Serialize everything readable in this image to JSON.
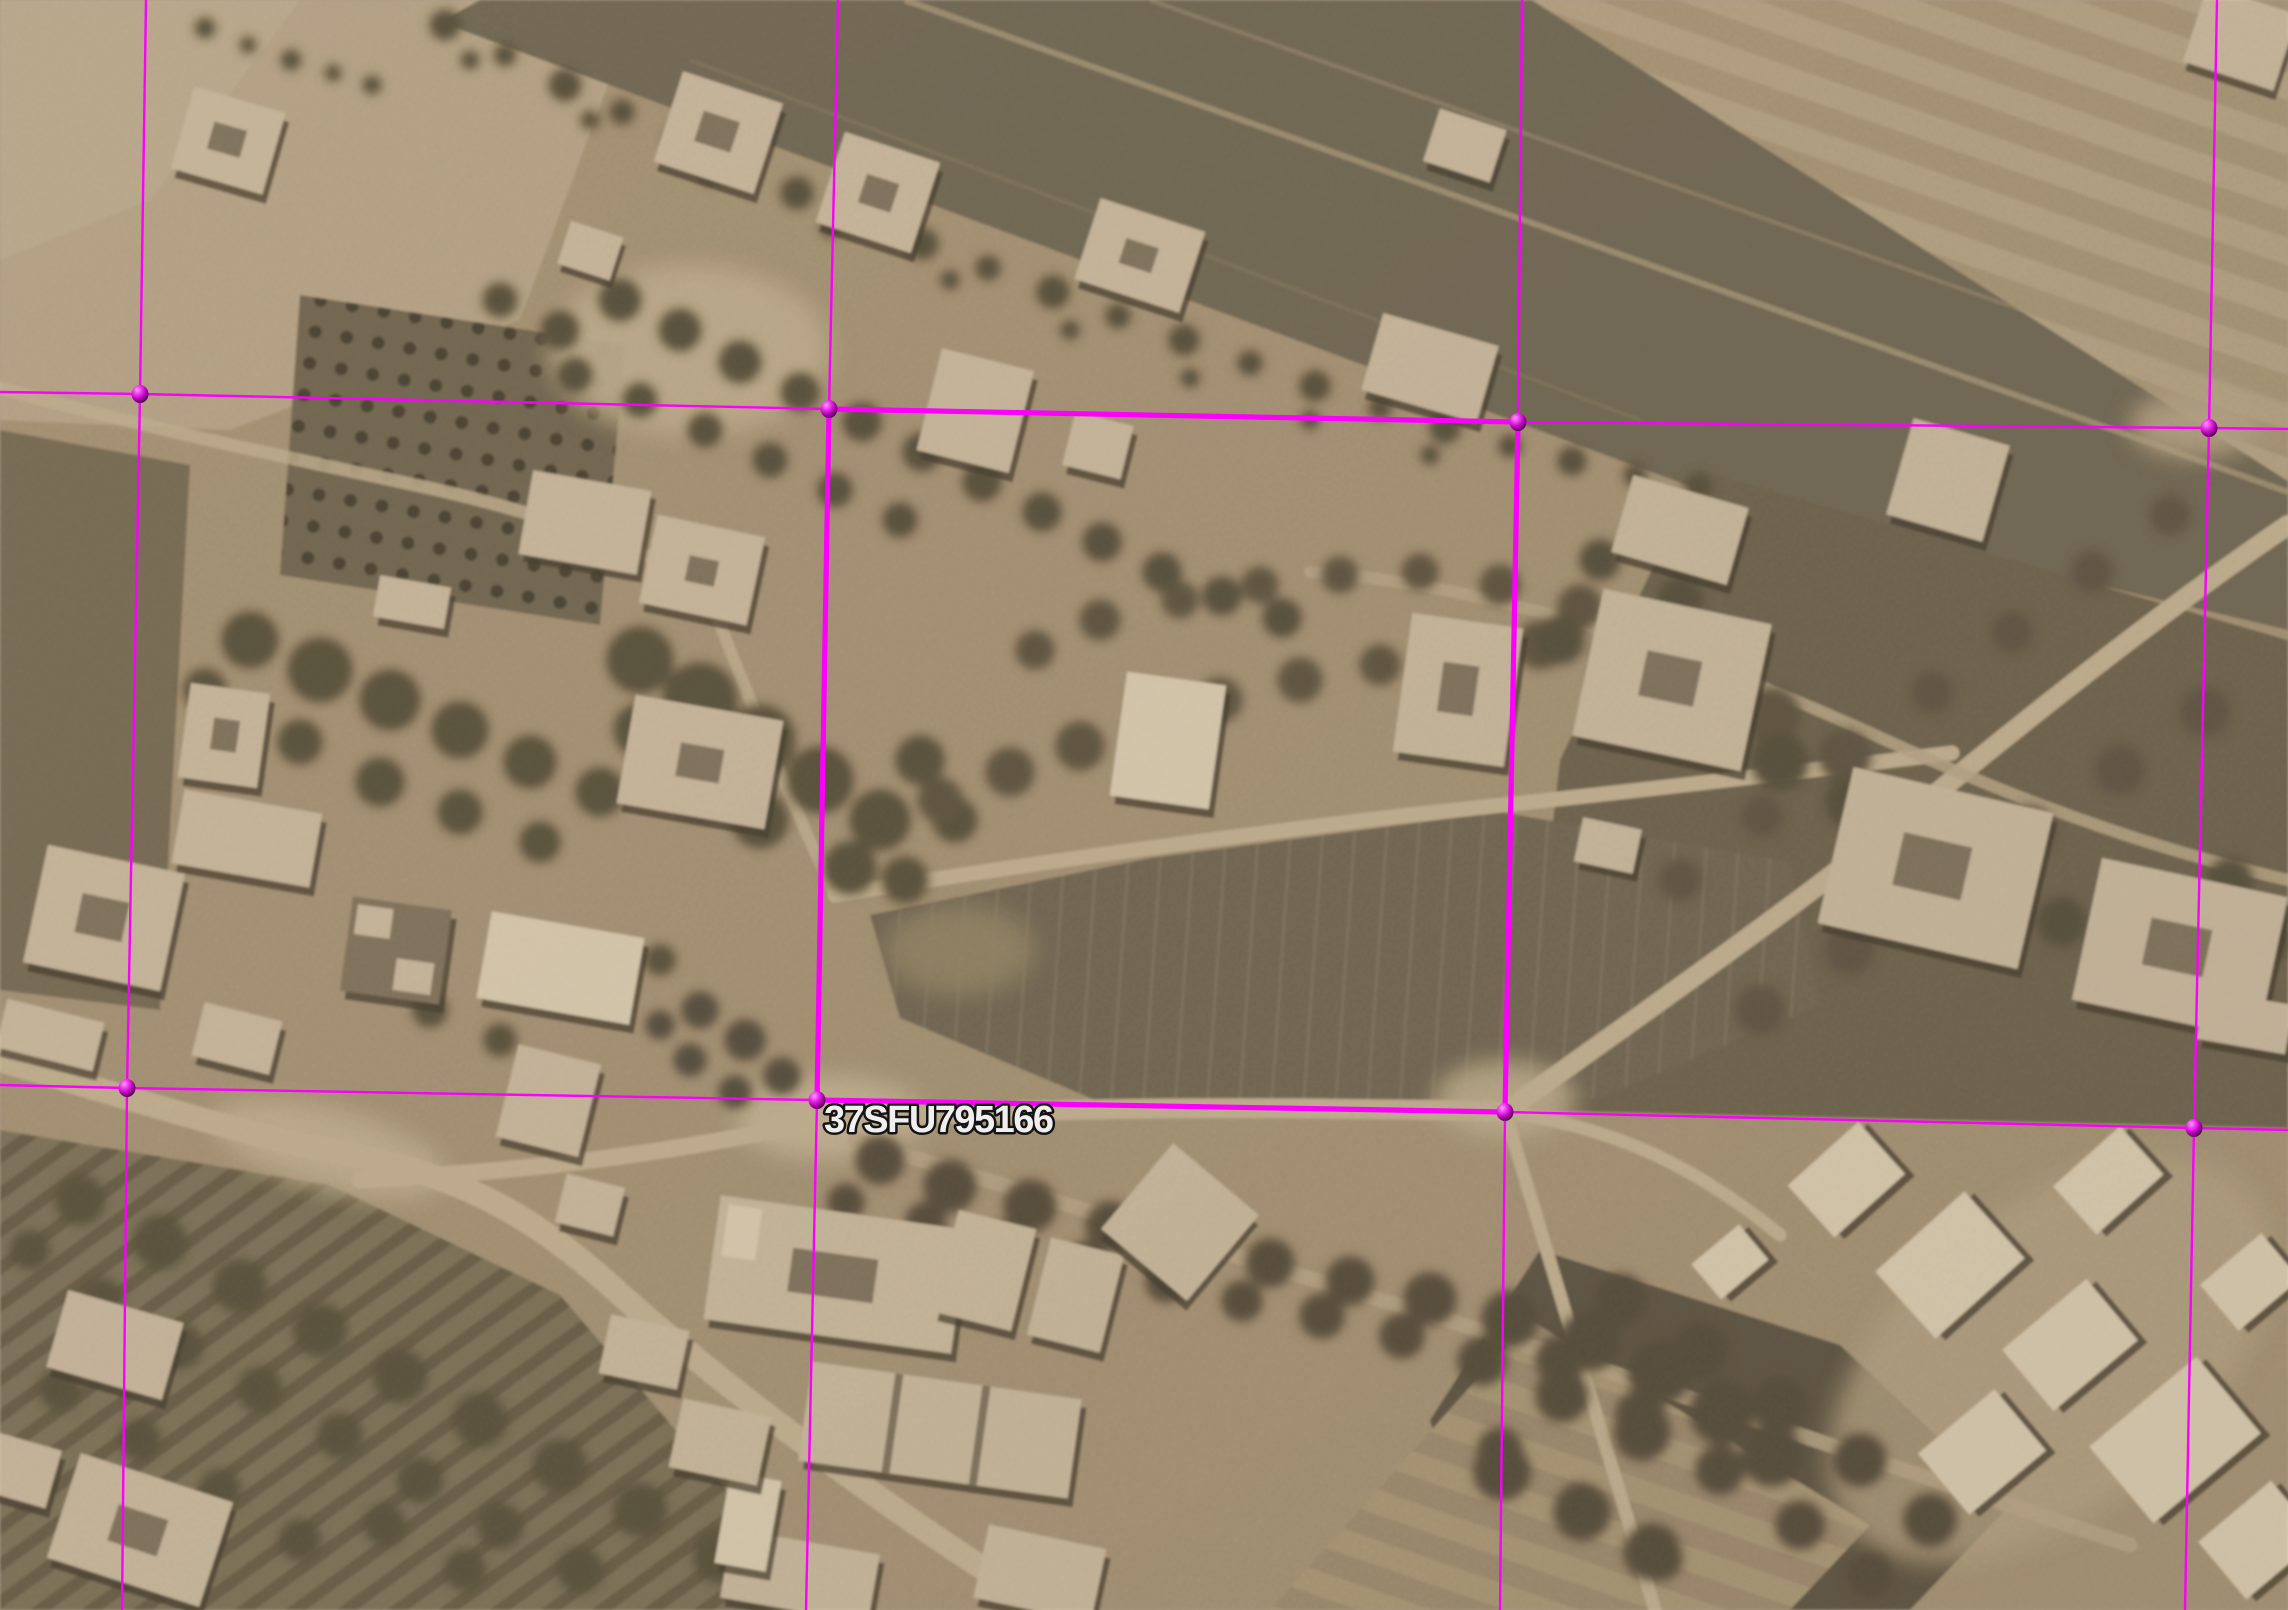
{
  "map": {
    "view": "satellite-imagery",
    "mgrs_label": {
      "text": "37SFU795166",
      "x": 824,
      "y": 1132,
      "fill": "#f1efed",
      "outline": "#141414"
    },
    "grid": {
      "color": "#fb00fb",
      "thin_width": 2.4,
      "thick_width": 5.2,
      "node_rx": 8.5,
      "node_ry": 9,
      "thin_lines": [
        [
          [
            0,
            392
          ],
          [
            140,
            394
          ],
          [
            829,
            409
          ],
          [
            1518,
            422
          ],
          [
            2209,
            428
          ],
          [
            2288,
            429
          ]
        ],
        [
          [
            0,
            1085
          ],
          [
            127,
            1088
          ],
          [
            817,
            1100
          ],
          [
            1505,
            1112
          ],
          [
            2194,
            1128
          ],
          [
            2288,
            1130
          ]
        ],
        [
          [
            146,
            0
          ],
          [
            140,
            394
          ],
          [
            127,
            1088
          ],
          [
            122,
            1610
          ]
        ],
        [
          [
            838,
            0
          ],
          [
            829,
            409
          ],
          [
            817,
            1100
          ],
          [
            806,
            1610
          ]
        ],
        [
          [
            1522,
            0
          ],
          [
            1518,
            422
          ],
          [
            1505,
            1112
          ],
          [
            1500,
            1610
          ]
        ],
        [
          [
            2217,
            0
          ],
          [
            2209,
            428
          ],
          [
            2194,
            1128
          ],
          [
            2185,
            1610
          ]
        ]
      ],
      "highlight_cell": [
        [
          829,
          409
        ],
        [
          1518,
          422
        ],
        [
          1505,
          1112
        ],
        [
          817,
          1100
        ]
      ],
      "nodes": [
        [
          140,
          394
        ],
        [
          829,
          409
        ],
        [
          1518,
          422
        ],
        [
          2209,
          428
        ],
        [
          127,
          1088
        ],
        [
          817,
          1100
        ],
        [
          1505,
          1112
        ],
        [
          2194,
          1128
        ]
      ]
    }
  }
}
